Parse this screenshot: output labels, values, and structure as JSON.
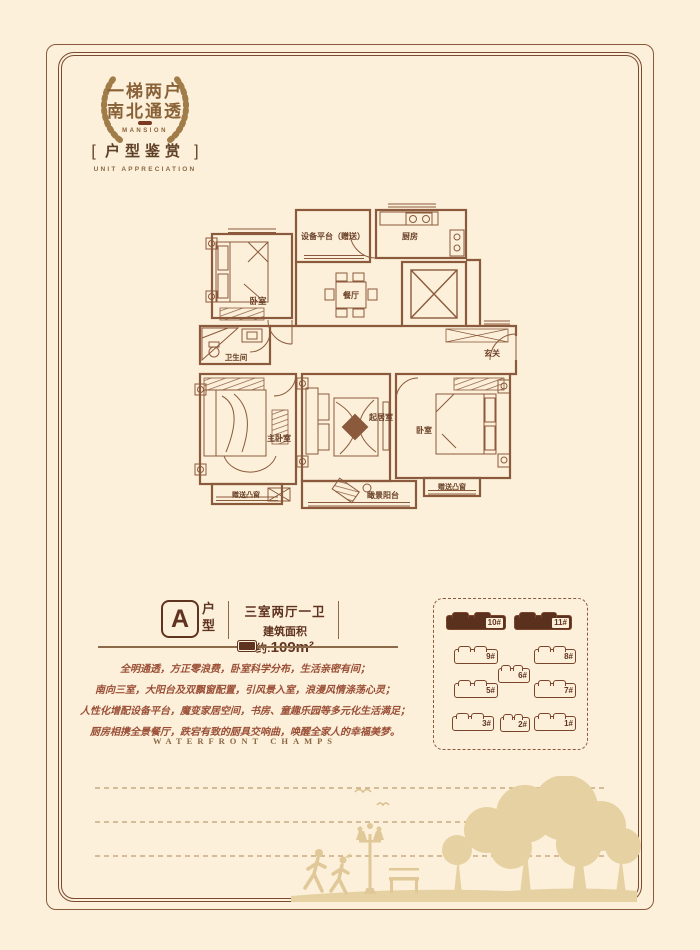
{
  "badge": {
    "line1": "一梯两户",
    "line2": "南北通透",
    "subtitle": "MANSION"
  },
  "section": {
    "bracket_left": "[",
    "title": "户型鉴赏",
    "bracket_right": "]",
    "subtitle": "UNIT APPRECIATION"
  },
  "floorplan": {
    "rooms": {
      "bedroom1": "卧室",
      "equipment": "设备平台（赠送）",
      "dining": "餐厅",
      "kitchen": "厨房",
      "entry": "玄关",
      "bathroom": "卫生间",
      "master": "主卧室",
      "living": "起居室",
      "bedroom2": "卧室",
      "bay_left": "赠送凸窗",
      "bay_right": "赠送凸窗",
      "balcony": "瞰景阳台"
    }
  },
  "unit": {
    "letter": "A",
    "type_label": "户型",
    "spec": "三室两厅一卫",
    "area_prefix": "建筑面积约:",
    "area_value": "109m²"
  },
  "description": {
    "lines": [
      "全明通透，方正零浪费，卧室科学分布，生活亲密有间；",
      "南向三室，大阳台及双飘窗配置，引风景入室，浪漫风情涤荡心灵；",
      "人性化增配设备平台，魔变家居空间，书房、童趣乐园等多元化生活满足；",
      "厨房相携全景餐厅，跌宕有致的厨具交响曲，唤醒全家人的幸福美梦。"
    ]
  },
  "footer_en": "WATERFRONT  CHAMPS",
  "siteplan": {
    "buildings": [
      {
        "label": "10#",
        "highlight": true
      },
      {
        "label": "11#",
        "highlight": true
      },
      {
        "label": "9#",
        "highlight": false
      },
      {
        "label": "8#",
        "highlight": false
      },
      {
        "label": "6#",
        "highlight": false
      },
      {
        "label": "5#",
        "highlight": false
      },
      {
        "label": "7#",
        "highlight": false
      },
      {
        "label": "3#",
        "highlight": false
      },
      {
        "label": "2#",
        "highlight": false
      },
      {
        "label": "1#",
        "highlight": false
      }
    ]
  },
  "colors": {
    "background": "#fcf0da",
    "line_brown": "#8b5a3c",
    "dark_brown": "#5f3320",
    "description_text": "#9b4f37",
    "silhouette": "#e6d1a3",
    "highlight_building": "#5a311d"
  }
}
